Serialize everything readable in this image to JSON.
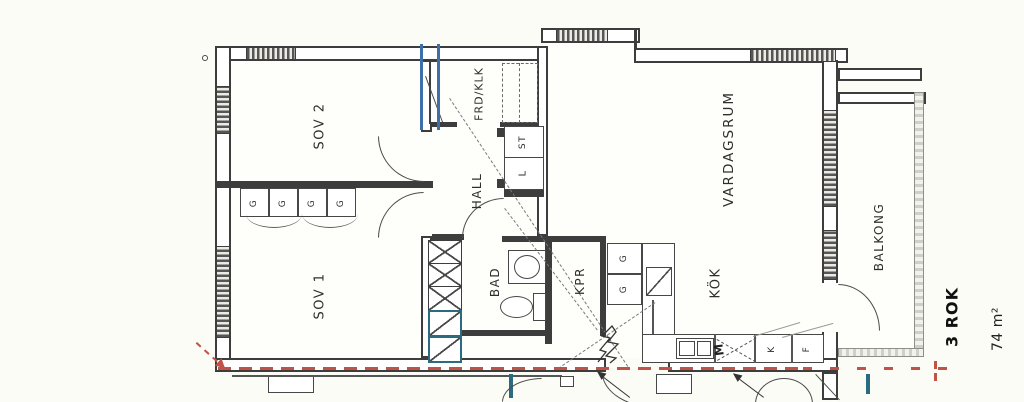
{
  "plan": {
    "rooms": {
      "sov2": "SOV 2",
      "sov1": "SOV 1",
      "frd_klk": "FRD/KLK",
      "hall": "HALL",
      "bad": "BAD",
      "kpr": "KPR",
      "vardagsrum": "VARDAGSRUM",
      "kok": "KÖK",
      "balkong": "BALKONG"
    },
    "fixtures": {
      "wardrobe": "G",
      "cleaning_closet": "ST",
      "linen_closet": "L",
      "fridge": "K",
      "freezer": "F",
      "machine": "M"
    },
    "summary": {
      "layout": "3 ROK",
      "area": "74 m²"
    },
    "colors": {
      "line": "#3d3d3d",
      "boundary_red": "#c05247",
      "plumbing_teal": "#2b6b80",
      "wall_blue": "#3f6fa8"
    }
  }
}
